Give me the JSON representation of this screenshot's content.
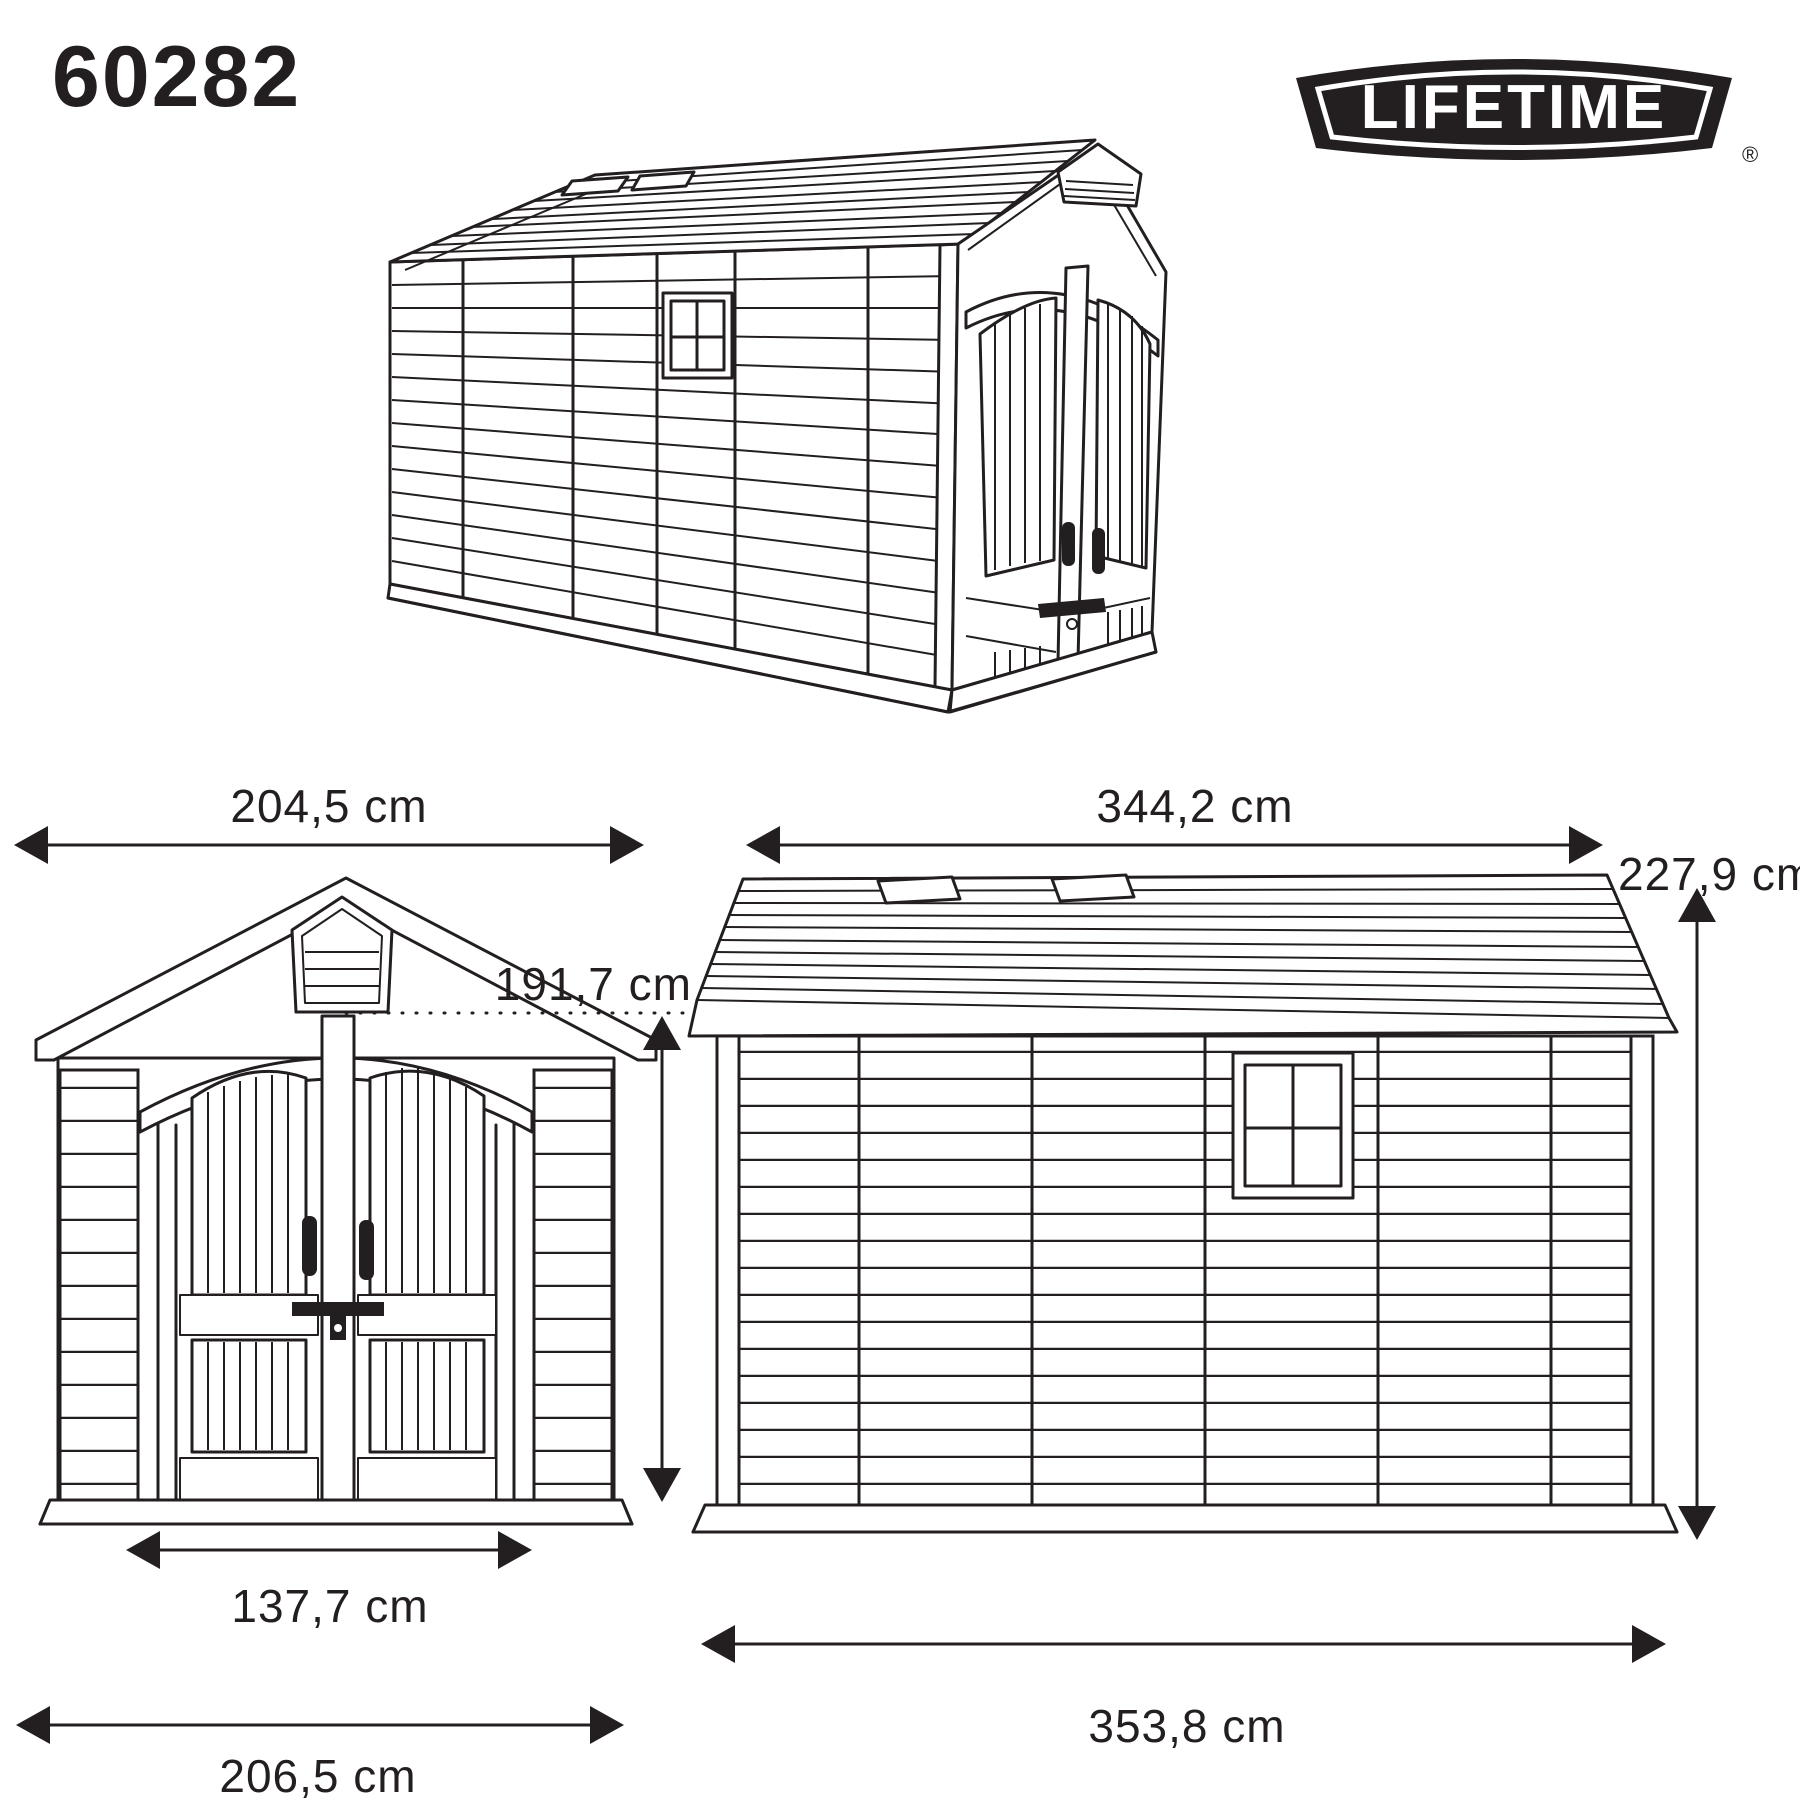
{
  "page": {
    "background": "#ffffff",
    "ink_color": "#231f20"
  },
  "header": {
    "model_number": "60282",
    "brand": {
      "text": "LIFETIME",
      "registered_mark": "®",
      "badge_color": "#231f20",
      "text_color": "#ffffff"
    }
  },
  "diagram": {
    "product": "storage shed line drawing",
    "views": [
      {
        "id": "iso",
        "name": "3d-perspective-view",
        "description": "three-quarter perspective of shed with double doors, gable vent, side window and roof skylights"
      },
      {
        "id": "front",
        "name": "front-elevation",
        "description": "front view with arched double doors, gable louver vent, handles and latch"
      },
      {
        "id": "side",
        "name": "side-elevation",
        "description": "side view with horizontal siding, four-pane window and roof skylights"
      }
    ],
    "dimensions": {
      "front_width_top": "204,5 cm",
      "front_height": "191,7 cm",
      "door_width": "137,7 cm",
      "front_width_base": "206,5 cm",
      "side_length_roof": "344,2 cm",
      "total_height": "227,9 cm",
      "side_length_base": "353,8 cm"
    }
  }
}
